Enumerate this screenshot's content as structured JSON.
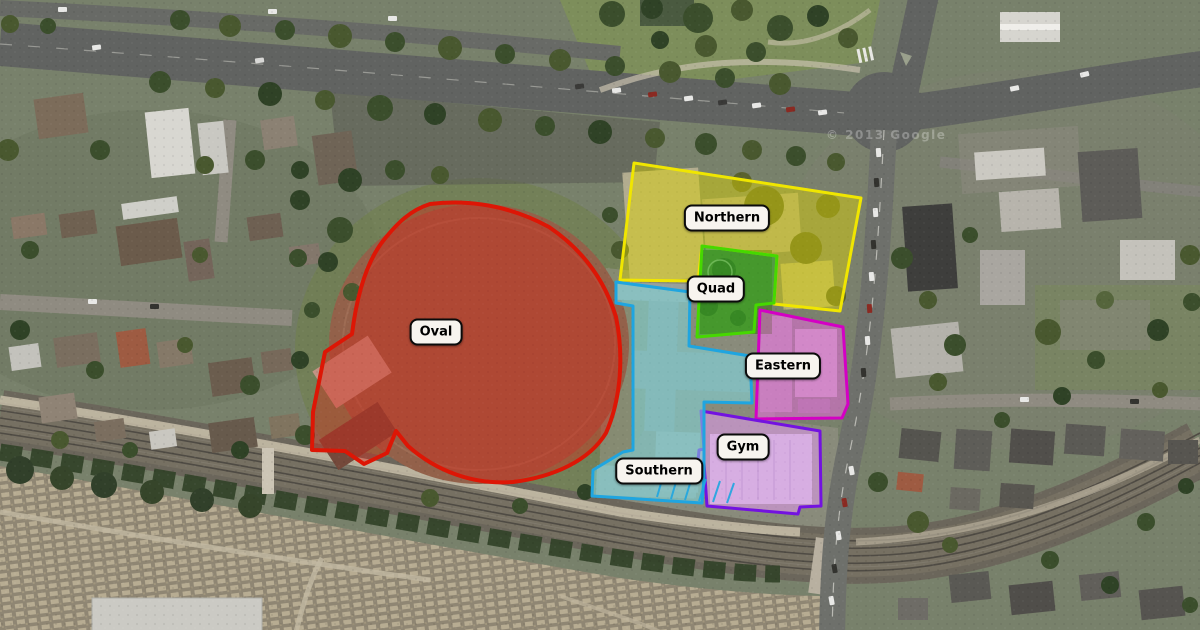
{
  "map": {
    "kind": "satellite-aerial-campus-map",
    "watermark": "© 2013 Google"
  },
  "regions": [
    {
      "id": "oval",
      "label": "Oval",
      "border": "#dd1605",
      "fill": "#d92313",
      "fill_opacity": "0.40"
    },
    {
      "id": "northern",
      "label": "Northern",
      "border": "#f0e600",
      "fill": "#ded400",
      "fill_opacity": "0.45"
    },
    {
      "id": "quad",
      "label": "Quad",
      "border": "#46d800",
      "fill": "#2fb51c",
      "fill_opacity": "0.50"
    },
    {
      "id": "eastern",
      "label": "Eastern",
      "border": "#d400c4",
      "fill": "#ef6ae6",
      "fill_opacity": "0.50"
    },
    {
      "id": "gym",
      "label": "Gym",
      "border": "#7312e0",
      "fill": "#e29af0",
      "fill_opacity": "0.55"
    },
    {
      "id": "southern",
      "label": "Southern",
      "border": "#1fa5e0",
      "fill": "#7fd8dc",
      "fill_opacity": "0.55"
    }
  ]
}
